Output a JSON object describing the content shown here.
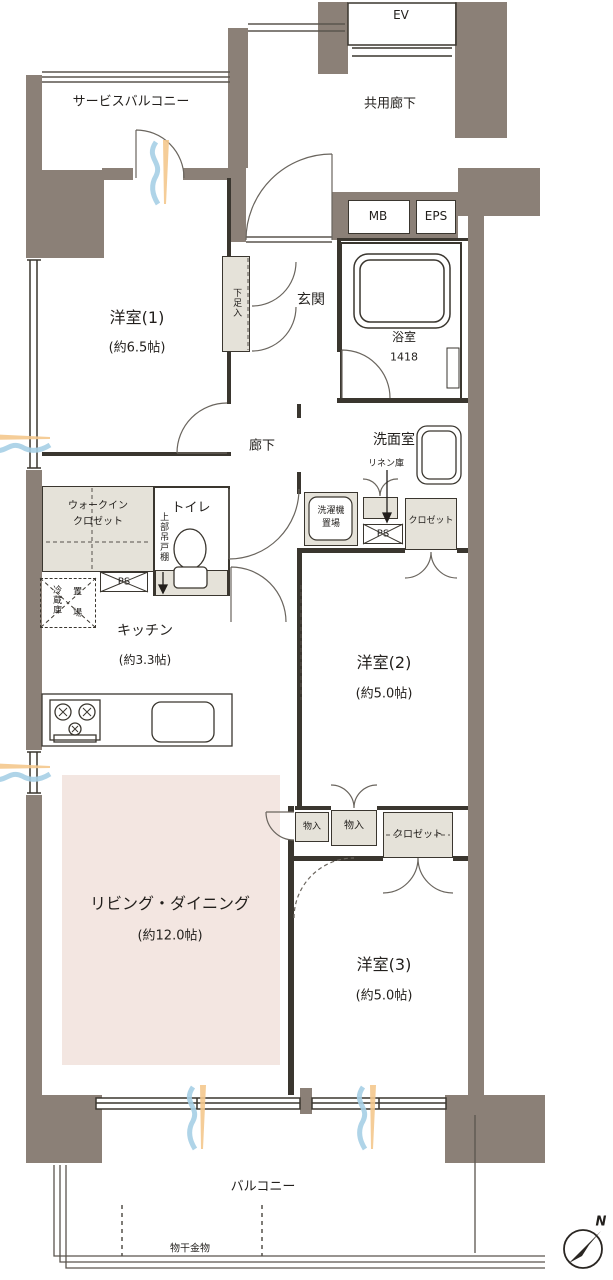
{
  "common": {
    "ev": "EV",
    "shared_corridor": "共用廊下",
    "service_balcony": "サービスバルコニー",
    "mb": "MB",
    "eps": "EPS"
  },
  "rooms": {
    "western1": {
      "name": "洋室(1)",
      "size": "(約6.5帖)"
    },
    "western2": {
      "name": "洋室(2)",
      "size": "(約5.0帖)"
    },
    "western3": {
      "name": "洋室(3)",
      "size": "(約5.0帖)"
    },
    "living_dining": {
      "name": "リビング・ダイニング",
      "size": "(約12.0帖)"
    },
    "kitchen": {
      "name": "キッチン",
      "size": "(約3.3帖)"
    },
    "bathroom": {
      "name": "浴室",
      "size": "1418"
    },
    "washroom": {
      "name": "洗面室"
    },
    "entrance": {
      "name": "玄関"
    },
    "hallway": {
      "name": "廊下"
    },
    "toilet": {
      "name": "トイレ"
    }
  },
  "storage": {
    "shoe_cabinet": "下足入",
    "walk_in_closet": {
      "line1": "ウォークイン",
      "line2": "クロゼット"
    },
    "upper_cabinet": "上部吊戸棚",
    "linen": "リネン庫",
    "washer": {
      "line1": "洗濯機",
      "line2": "置場"
    },
    "washroom_closet": "クロゼット",
    "storage_a": "物入",
    "storage_b": "物入",
    "bedroom3_closet": "クロゼット",
    "fridge": {
      "line1": "冷蔵庫",
      "line2": "置 場"
    }
  },
  "shafts": {
    "ps_kitchen": "PS",
    "ps_washroom": "PS"
  },
  "balcony": {
    "name": "バルコニー",
    "drying_hardware": "物干金物"
  },
  "compass": {
    "north": "N"
  },
  "colors": {
    "wall": "#8b8077",
    "living_fill": "#f3e6e1",
    "closet_fill": "#e5e2d9",
    "outline": "#3a362f",
    "wind_orange": "#f4c88d",
    "wind_blue": "#a6cfe5"
  }
}
